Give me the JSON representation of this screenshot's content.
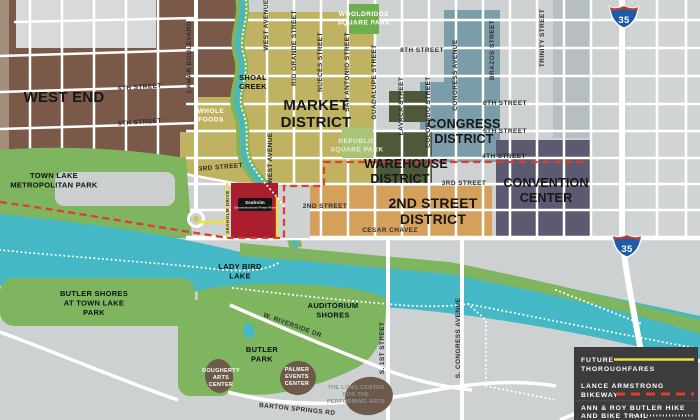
{
  "districts": {
    "west_end": "WEST END",
    "market": [
      "MARKET",
      "DISTRICT"
    ],
    "congress": [
      "CONGRESS",
      "DISTRICT"
    ],
    "warehouse": [
      "WAREHOUSE",
      "DISTRICT"
    ],
    "second_street": [
      "2ND STREET",
      "DISTRICT"
    ],
    "convention": [
      "CONVENTION",
      "CENTER"
    ]
  },
  "parks": {
    "town_lake": [
      "TOWN LAKE",
      "METROPOLITAN PARK"
    ],
    "shoal_creek": [
      "SHOAL",
      "CREEK"
    ],
    "wooldridge": [
      "WOOLDRIDGE",
      "SQUARE PARK"
    ],
    "republic": [
      "REPUBLIC",
      "SQUARE PARK"
    ],
    "lady_bird": [
      "LADY BIRD",
      "LAKE"
    ],
    "butler_shores": [
      "BUTLER SHORES",
      "AT TOWN LAKE",
      "PARK"
    ],
    "auditorium": [
      "AUDITORIUM",
      "SHORES"
    ],
    "butler_park": [
      "BUTLER",
      "PARK"
    ]
  },
  "places": {
    "whole_foods": [
      "WHOLE",
      "FOODS"
    ],
    "seaholm": [
      "Seaholm",
      "Decommissioned Power Plant"
    ],
    "dougherty": [
      "DOUGHERTY",
      "ARTS",
      "CENTER"
    ],
    "palmer": [
      "PALMER",
      "EVENTS",
      "CENTER"
    ],
    "long_center": [
      "THE LONG CENTER",
      "FOR THE",
      "PERFORMING ARTS"
    ]
  },
  "streets": {
    "eighth": "8TH STREET",
    "sixth_w": "6TH STREET",
    "fifth_w": "5TH STREET",
    "sixth_e": "6TH STREET",
    "fifth_e": "5TH STREET",
    "fourth": "4TH STREET",
    "third_w": "3RD STREET",
    "third_e": "3RD STREET",
    "second": "2ND STREET",
    "cesar_chavez": "CESAR CHAVEZ",
    "riverside": "W. RIVERSIDE DR",
    "barton_springs": "BARTON SPRINGS RD",
    "lamar": "LAMAR BOULEVARD",
    "west_ave": "WEST AVENUE",
    "rio_grande": "RIO GRANDE STREET",
    "nueces": "NUECES STREET",
    "san_antonio": "SAN ANTONIO STREET",
    "guadalupe": "GUADALUPE STREET",
    "lavaca": "LAVACA STREET",
    "colorado": "COLORADO STREET",
    "congress": "CONGRESS AVENUE",
    "brazos": "BRAZOS STREET",
    "trinity": "TRINITY STREET",
    "seaholm_dr": "SEAHOLM DRIVE",
    "s_first": "S. 1ST STREET",
    "s_congress": "S. CONGRESS AVENUE"
  },
  "highway": {
    "i35": "35"
  },
  "legend": {
    "future": [
      "FUTURE",
      "THOROUGHFARES"
    ],
    "bikeway": [
      "LANCE ARMSTRONG",
      "BIKEWAY"
    ],
    "trail": [
      "ANN & ROY BUTLER HIKE",
      "AND BIKE TRAIL"
    ]
  },
  "colors": {
    "west_end": "#7b5948",
    "market": "#bfb261",
    "congress": "#7b9da9",
    "warehouse": "#4d5939",
    "second_street": "#d4a05c",
    "convention": "#5b5a70",
    "park_green": "#7eb55e",
    "water": "#45b8c6",
    "seaholm_red": "#aa1f2f",
    "bikeway_red": "#e23b30",
    "future_yellow": "#ece23a",
    "legend_bg": "#3d3c3c"
  }
}
